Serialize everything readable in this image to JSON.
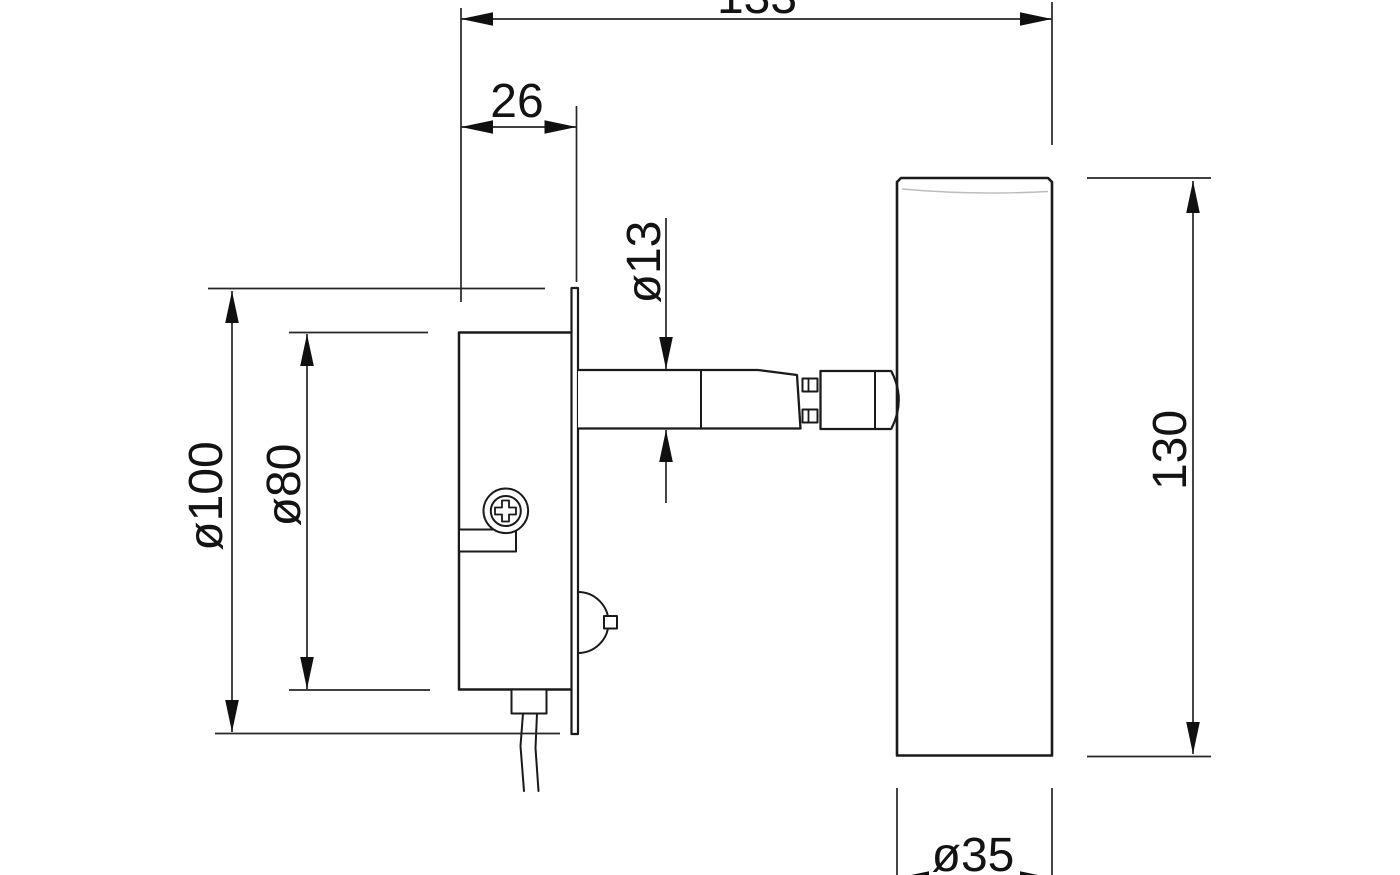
{
  "canvas": {
    "background": "#ffffff",
    "line_color": "#1a1a1a"
  },
  "drawing": {
    "kind": "dimensioned-technical-line-drawing",
    "view": "side view of a wall-mounted swivel spotlight",
    "units_implied": "mm",
    "parts": {
      "wall_plate": "round wall plate seen edge-on",
      "junction_box": "recessed junction box behind the plate",
      "screw": "phillips mounting screw",
      "tab": "small mounting tab on box",
      "strain_relief": "cable strain relief at box bottom",
      "cable": "power cable",
      "switch": "domed push switch on plate front",
      "arm": "cylindrical swivel arm with hinge",
      "head": "cylindrical lamp head"
    }
  },
  "dimensions": {
    "overall_depth": {
      "label": "133",
      "value": 133,
      "note": "top horizontal dimension, text partially cropped at image top"
    },
    "recess_depth": {
      "label": "26",
      "value": 26,
      "note": "box front face to wall plate face"
    },
    "arm_diameter": {
      "label": "ø13",
      "value": 13,
      "note": "swivel arm tube diameter"
    },
    "plate_diameter": {
      "label": "ø100",
      "value": 100,
      "note": "wall plate diameter"
    },
    "box_diameter": {
      "label": "ø80",
      "value": 80,
      "note": "recessed box diameter"
    },
    "head_length": {
      "label": "130",
      "value": 130,
      "note": "lamp head length"
    },
    "head_diameter": {
      "label": "ø35",
      "value": 35,
      "note": "lamp head diameter, dimension line cropped at image bottom"
    }
  }
}
